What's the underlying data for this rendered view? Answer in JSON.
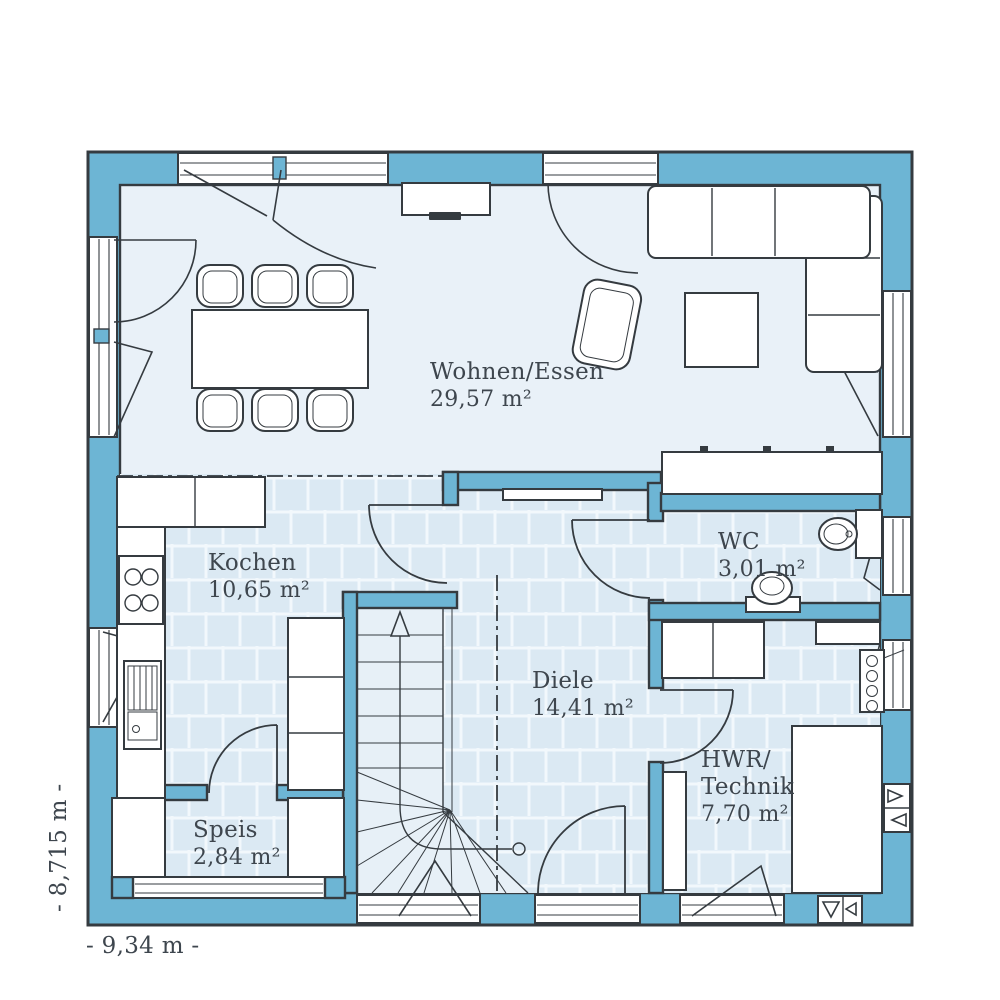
{
  "plan": {
    "rooms": {
      "wohnen": {
        "name": "Wohnen/Essen",
        "area": "29,57 m²"
      },
      "kochen": {
        "name": "Kochen",
        "area": "10,65 m²"
      },
      "wc": {
        "name": "WC",
        "area": "3,01 m²"
      },
      "diele": {
        "name": "Diele",
        "area": "14,41 m²"
      },
      "speis": {
        "name": "Speis",
        "area": "2,84 m²"
      },
      "hwr": {
        "name_line1": "HWR/",
        "name_line2": "Technik",
        "area": "7,70 m²"
      }
    },
    "dimensions": {
      "width_label": "- 9,34 m -",
      "height_label": "- 8,715 m -"
    },
    "colors": {
      "wall": "#6db5d4",
      "outline": "#353b40",
      "floor": "#e9f1f8",
      "tile": "#dbe9f3",
      "text": "#3e464e"
    }
  }
}
